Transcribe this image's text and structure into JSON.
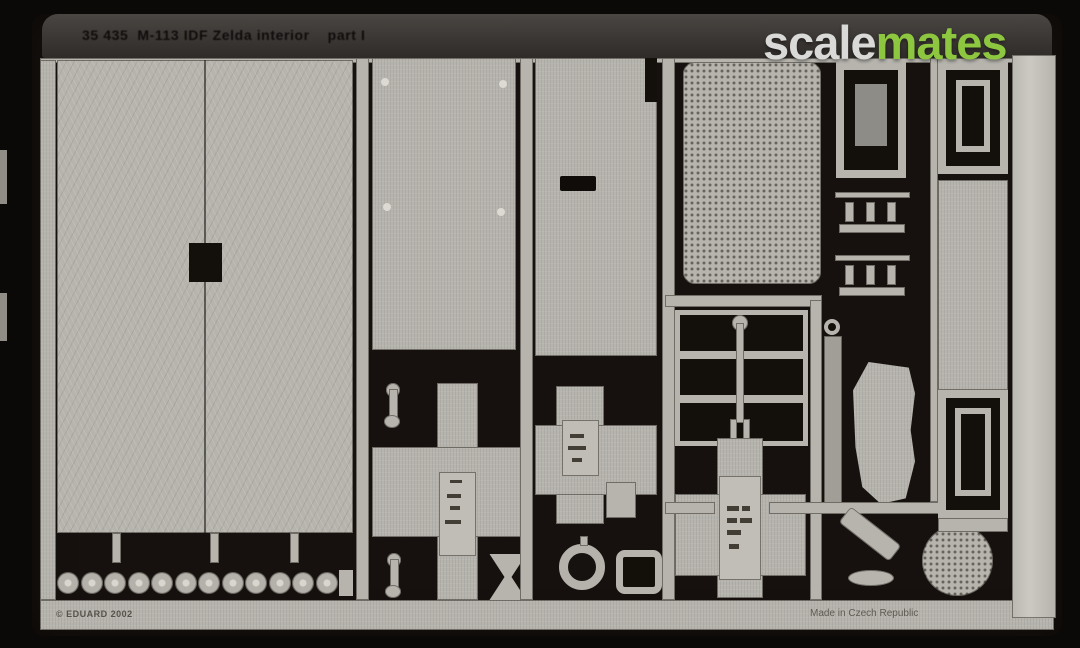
{
  "photo": {
    "fret_title": "35 435  M-113 IDF Zelda interior    part I",
    "copyright": "© EDUARD 2002",
    "made_in": "Made in Czech Republic",
    "disc_count": 12,
    "parts": [
      "anti-slip-floor-panel",
      "wheel-cap-disc-row",
      "textured-panel-a",
      "textured-panel-b",
      "cross-bracket-a",
      "cross-bracket-b",
      "cross-bracket-c",
      "perforated-panel",
      "frame-with-window",
      "ladder-bracket-1",
      "ladder-bracket-2",
      "long-strip-with-ring",
      "hull-side-part",
      "boot-shaped-part",
      "large-disc",
      "nested-frame-top",
      "nested-frame-bottom",
      "tall-blank-panel",
      "right-margin-strip"
    ]
  },
  "watermark": {
    "scale": "scale",
    "mates": "mates"
  },
  "colors": {
    "background": "#0b0908",
    "etched_dark": "#16110e",
    "metal": "#b6b4ad",
    "title_band": "#3e3b38",
    "window_gray": "#8e8c86",
    "watermark_gray": "#d9d9d7",
    "watermark_green": "#8dc63f"
  }
}
